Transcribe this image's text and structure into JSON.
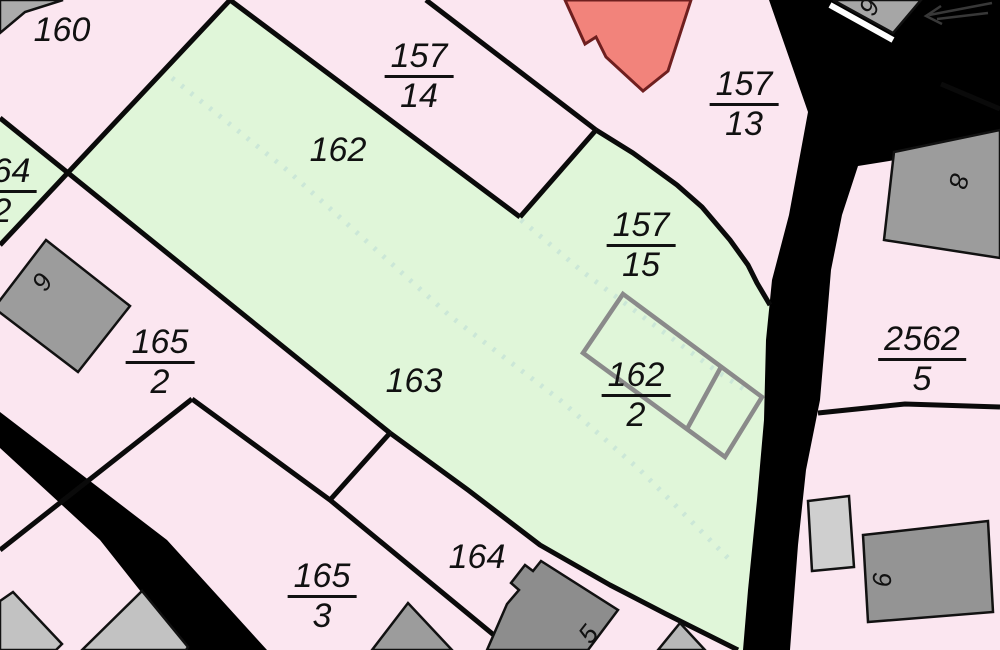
{
  "map": {
    "canvas": {
      "width": 1000,
      "height": 650
    },
    "colors": {
      "parcel_pink": "#fbe6f0",
      "parcel_green": "#e0f6d9",
      "road_black": "#000000",
      "boundary_line": "#0a0a0a",
      "dashed_boundary": "#cbe7d7",
      "building_gray_dark": "#8d8d8d",
      "building_gray_mid": "#9c9c9c",
      "building_gray_light": "#c9c9c9",
      "building_outline_gray": "#8a8a8a",
      "red_building_fill": "#f2837b",
      "red_building_stroke": "#6f1f1f",
      "white_gap": "#ffffff",
      "label_color": "#111111"
    },
    "areas": [
      {
        "name": "green-parcel-main-162-163-157-15",
        "fill": "#e0f6d9",
        "points": "230,0 68,173 390,433 468,490 540,545 610,585 666,614 738,650 743,650 748,590 757,500 764,420 766,340 771,300 757,283 748,265 730,240 702,207 677,185 633,153 596,130 520,217"
      },
      {
        "name": "green-parcel-sliver-164-2",
        "fill": "#e0f6d9",
        "points": "0,118 68,173 0,245"
      }
    ],
    "dashed_boundaries": [
      {
        "name": "dashed-boundary-162-163",
        "points": "172,78 287,170 450,316 560,400 640,470 730,560"
      },
      {
        "name": "dashed-boundary-162-157-15",
        "points": "521,220 583,272 650,322 715,370 748,392"
      }
    ],
    "roads": [
      {
        "name": "road-main-right",
        "points": "769,0 1000,0 1000,143 858,166 842,215 831,270 826,330 820,400 806,470 798,545 790,650 743,650 748,590 757,500 764,420 766,340 772,280 789,215 808,112"
      },
      {
        "name": "road-band-bottom-left",
        "points": "0,412 167,540 267,650 187,650 100,540 0,448"
      }
    ],
    "white_stripe": {
      "name": "white-gap-building9",
      "x1": 830,
      "y1": 5,
      "x2": 893,
      "y2": 40
    },
    "arrow": {
      "name": "north-arrow",
      "stroke": "#383838",
      "lines": [
        [
          992,
          3,
          929,
          15
        ],
        [
          988,
          13,
          937,
          19
        ]
      ],
      "head": "941,6 926,16 942,24"
    },
    "boundary_lines": [
      {
        "name": "boundary-160-164-2-A",
        "points": "0,118 390,433"
      },
      {
        "name": "boundary-160-162-B",
        "points": "230,0 0,245"
      },
      {
        "name": "boundary-157-14-upper",
        "points": "426,0 596,130"
      },
      {
        "name": "boundary-157-14-lower",
        "points": "230,0 520,217"
      },
      {
        "name": "boundary-157-14-close",
        "points": "520,217 596,130"
      },
      {
        "name": "boundary-157-15-east",
        "points": "596,130 633,153 677,185 702,207 730,240 748,265 757,283 770,305"
      },
      {
        "name": "boundary-163-164",
        "points": "390,433 468,490 540,545 610,585 666,614 738,650"
      },
      {
        "name": "boundary-165-3-upper",
        "points": "192,399 330,500 512,650"
      },
      {
        "name": "boundary-165-2-west",
        "points": "192,399 0,550"
      },
      {
        "name": "boundary-164-connector",
        "points": "390,433 330,500"
      },
      {
        "name": "boundary-2562-5-south",
        "points": "818,413 905,404 1000,407"
      },
      {
        "name": "boundary-2562-5-north",
        "points": "941,84 1000,109"
      }
    ],
    "red_building": {
      "name": "building-red",
      "points": "565,0 585,44 596,37 606,57 643,91 668,71 691,0",
      "fill": "#f2837b",
      "stroke": "#6f1f1f"
    },
    "buildings": [
      {
        "name": "building-corner-top-left",
        "fill": "#ababab",
        "points": "0,0 63,0 25,12 0,33"
      },
      {
        "name": "building-9-top",
        "fill": "#a6a6a6",
        "points": "833,0 921,0 893,33"
      },
      {
        "name": "building-8",
        "fill": "#9c9c9c",
        "points": "894,152 1000,130 1000,258 884,240"
      },
      {
        "name": "building-9-parcel-165-2",
        "fill": "#9c9c9c",
        "points": "46,240 130,306 78,372 -6,308"
      },
      {
        "name": "building-small-light",
        "fill": "#cfcfcf",
        "points": "808,501 849,496 854,567 812,571"
      },
      {
        "name": "building-6",
        "fill": "#949494",
        "points": "863,535 988,521 993,612 868,622"
      },
      {
        "name": "building-small-bottom-mid-right",
        "fill": "#b8b8b8",
        "points": "658,650 680,623 705,650"
      },
      {
        "name": "building-5",
        "fill": "#8d8d8d",
        "points": "487,650 507,604 519,590 511,583 525,565 533,571 541,561 618,610 588,650"
      },
      {
        "name": "building-bottom-center",
        "fill": "#9c9c9c",
        "points": "372,650 408,603 452,650"
      },
      {
        "name": "building-bottom-left-vertex",
        "fill": "#c2c2c2",
        "points": "82,650 142,591 188,647 186,650"
      },
      {
        "name": "building-bottom-left-corner",
        "fill": "#c2c2c2",
        "points": "0,601 13,592 62,644 56,650 0,650"
      }
    ],
    "building_outlines": [
      {
        "name": "building-outline-162-2",
        "stroke": "#8a8a8a",
        "points": "623,294 762,397 725,457 583,353",
        "partition": "687,429 721,367"
      }
    ],
    "labels": {
      "parcels": [
        {
          "kind": "plain",
          "text": "160",
          "x": 62,
          "y": 30
        },
        {
          "kind": "frac",
          "num": "157",
          "den": "14",
          "x": 419,
          "y": 76
        },
        {
          "kind": "frac",
          "num": "157",
          "den": "13",
          "x": 744,
          "y": 104
        },
        {
          "kind": "frac",
          "num": "164",
          "den": "2",
          "x": 2,
          "y": 191
        },
        {
          "kind": "plain",
          "text": "162",
          "x": 338,
          "y": 150
        },
        {
          "kind": "frac",
          "num": "157",
          "den": "15",
          "x": 641,
          "y": 245
        },
        {
          "kind": "frac",
          "num": "165",
          "den": "2",
          "x": 160,
          "y": 362
        },
        {
          "kind": "plain",
          "text": "163",
          "x": 414,
          "y": 381
        },
        {
          "kind": "frac",
          "num": "162",
          "den": "2",
          "x": 636,
          "y": 395
        },
        {
          "kind": "frac",
          "num": "2562",
          "den": "5",
          "x": 922,
          "y": 359
        },
        {
          "kind": "frac",
          "num": "165",
          "den": "3",
          "x": 322,
          "y": 596
        },
        {
          "kind": "plain",
          "text": "164",
          "x": 477,
          "y": 557
        }
      ],
      "buildings": [
        {
          "text": "9",
          "x": 869,
          "y": 7,
          "rot": -63
        },
        {
          "text": "8",
          "x": 959,
          "y": 181,
          "rot": 103
        },
        {
          "text": "9",
          "x": 42,
          "y": 282,
          "rot": -58
        },
        {
          "text": "5",
          "x": 588,
          "y": 634,
          "rot": -52
        },
        {
          "text": "6",
          "x": 882,
          "y": 580,
          "rot": -90
        }
      ]
    }
  }
}
